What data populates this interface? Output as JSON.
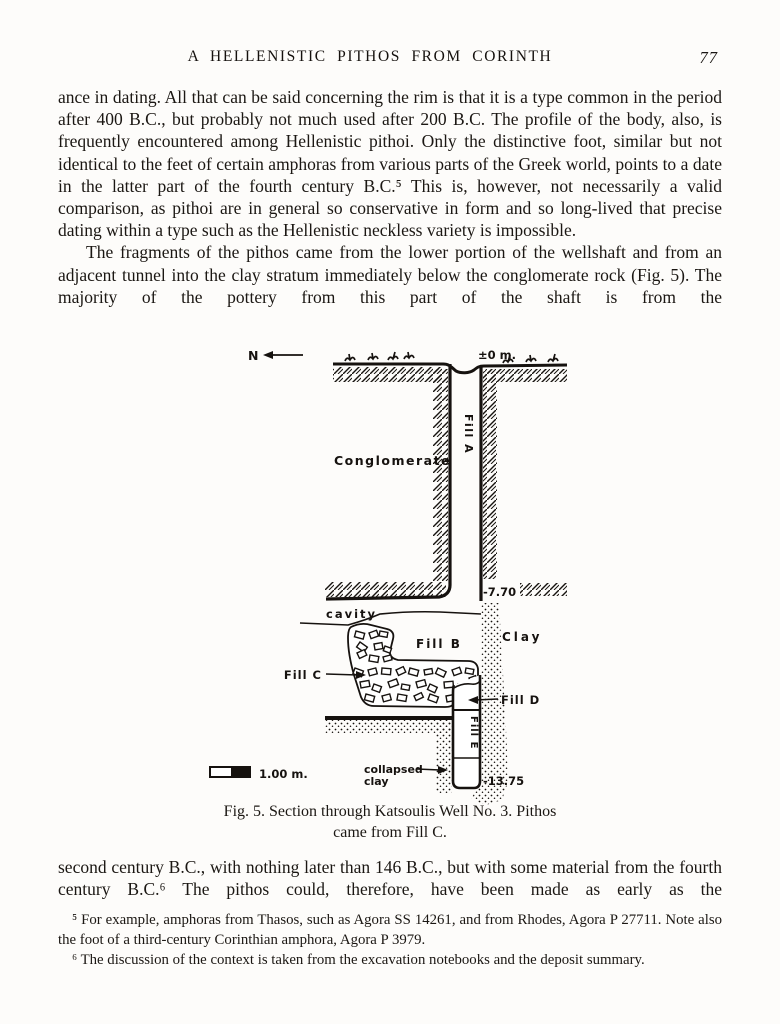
{
  "header": {
    "title": "A HELLENISTIC PITHOS FROM CORINTH",
    "page_number": "77"
  },
  "body": {
    "p1": "ance in dating. All that can be said concerning the rim is that it is a type common in the period after 400 B.C., but probably not much used after 200 B.C. The profile of the body, also, is frequently encountered among Hellenistic pithoi. Only the distinctive foot, similar but not identical to the feet of certain amphoras from various parts of the Greek world, points to a date in the latter part of the fourth century B.C.⁵ This is, however, not necessarily a valid comparison, as pithoi are in general so conservative in form and so long-lived that precise dating within a type such as the Hellenistic neckless variety is impossible.",
    "p2": "The fragments of the pithos came from the lower portion of the wellshaft and from an adjacent tunnel into the clay stratum immediately below the conglomerate rock (Fig. 5). The majority of the pottery from this part of the shaft is from the",
    "p3": "second century B.C., with nothing later than 146 B.C., but with some material from the fourth century B.C.⁶ The pithos could, therefore, have been made as early as the"
  },
  "figure": {
    "caption_line1": "Fig. 5. Section through Katsoulis Well No. 3. Pithos",
    "caption_line2": "came from Fill C.",
    "labels": {
      "north": "N",
      "datum": "±0 m.",
      "conglomerate": "Conglomerate",
      "fill_a": "Fill A",
      "depth_770": "-7.70",
      "cavity": "cavity",
      "fill_b": "Fill B",
      "clay": "Clay",
      "fill_c": "Fill C",
      "fill_d": "Fill D",
      "fill_e": "Fill E",
      "collapsed_line1": "collapsed",
      "collapsed_line2": "clay",
      "depth_1375": "-13.75",
      "scale": "1.00 m."
    }
  },
  "footnotes": {
    "fn5": "⁵ For example, amphoras from Thasos, such as Agora SS 14261, and from Rhodes, Agora P 27711. Note also the foot of a third-century Corinthian amphora, Agora P 3979.",
    "fn6": "⁶ The discussion of the context is taken from the excavation notebooks and the deposit summary."
  }
}
